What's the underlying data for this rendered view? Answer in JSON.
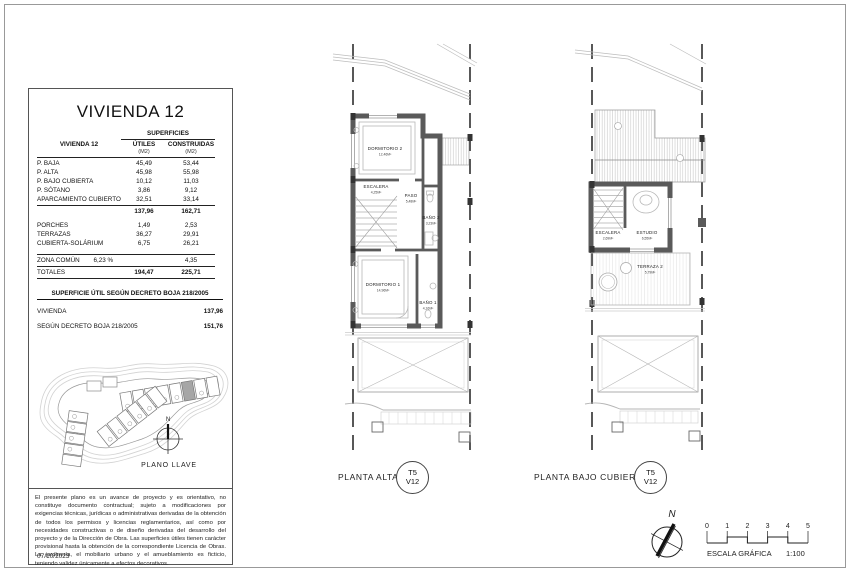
{
  "sheet": {
    "date": "07/10/2023",
    "disclaimer": "El presente plano es un avance de proyecto y es orientativo, no constituye documento contractual; sujeto a modificaciones por exigencias técnicas, jurídicas o administrativas derivadas de la obtención de todos los permisos y licencias reglamentarios, así como por necesidades constructivas o de diseño derivadas del desarrollo del proyecto y de la Dirección de Obra. Las superficies útiles tienen carácter provisional hasta la obtención de la correspondiente Licencia de Obras. La jardinería, el mobiliario urbano y el amueblamiento es ficticio, teniendo validez únicamente a efectos decorativos."
  },
  "panel": {
    "title": "VIVIENDA 12",
    "surfaces": {
      "group_header": "SUPERFICIES",
      "row_header": "VIVIENDA 12",
      "col_utiles": "ÚTILES",
      "col_construidas": "CONSTRUIDAS",
      "unit": "(M2)",
      "rows": [
        {
          "label": "P. BAJA",
          "utiles": "45,49",
          "construidas": "53,44"
        },
        {
          "label": "P. ALTA",
          "utiles": "45,98",
          "construidas": "55,98"
        },
        {
          "label": "P. BAJO CUBIERTA",
          "utiles": "10,12",
          "construidas": "11,03"
        },
        {
          "label": "P. SÓTANO",
          "utiles": "3,86",
          "construidas": "9,12"
        },
        {
          "label": "APARCAMIENTO CUBIERTO",
          "utiles": "32,51",
          "construidas": "33,14"
        }
      ],
      "subtotal": {
        "utiles": "137,96",
        "construidas": "162,71"
      },
      "extra_rows": [
        {
          "label": "PORCHES",
          "utiles": "1,49",
          "construidas": "2,53"
        },
        {
          "label": "TERRAZAS",
          "utiles": "36,27",
          "construidas": "29,91"
        },
        {
          "label": "CUBIERTA-SOLÁRIUM",
          "utiles": "6,75",
          "construidas": "26,21"
        }
      ],
      "zona_comun": {
        "label": "ZONA COMÚN",
        "pct": "6,23 %",
        "construidas": "4,35"
      },
      "totales": {
        "label": "TOTALES",
        "utiles": "194,47",
        "construidas": "225,71"
      }
    },
    "decreto": {
      "header": "SUPERFICIE ÚTIL SEGÚN DECRETO BOJA 218/2005",
      "rows": [
        {
          "label": "VIVIENDA",
          "value": "137,96"
        },
        {
          "label": "SEGÚN DECRETO BOJA 218/2005",
          "value": "151,76"
        }
      ]
    },
    "key_plan": {
      "north": "N",
      "label": "PLANO LLAVE"
    }
  },
  "plans": [
    {
      "caption": "PLANTA ALTA",
      "badge_top": "T5",
      "badge_bottom": "V12",
      "rooms": [
        {
          "name": "DORMITORIO 2",
          "area": "12,46M²"
        },
        {
          "name": "ESCALERA",
          "area": "4,25M²"
        },
        {
          "name": "PASO",
          "area": "5,48M²"
        },
        {
          "name": "BAÑO 2",
          "area": "3,23M²"
        },
        {
          "name": "DORMITORIO 1",
          "area": "14,96M²"
        },
        {
          "name": "BAÑO 1",
          "area": "4,16M²"
        }
      ]
    },
    {
      "caption": "PLANTA BAJO CUBIERTA",
      "badge_top": "T5",
      "badge_bottom": "V12",
      "rooms": [
        {
          "name": "ESCALERA",
          "area": "2,69M²"
        },
        {
          "name": "ESTUDIO",
          "area": "6,55M²"
        },
        {
          "name": "TERRAZA 2",
          "area": "5,79M²"
        }
      ]
    }
  ],
  "scale_bar": {
    "north": "N",
    "ticks": [
      "0",
      "1",
      "2",
      "3",
      "4",
      "5"
    ],
    "label": "ESCALA GRÁFICA",
    "ratio": "1:100"
  },
  "colors": {
    "wall": "#555555",
    "highlight_unit": "#a6a6a6"
  }
}
